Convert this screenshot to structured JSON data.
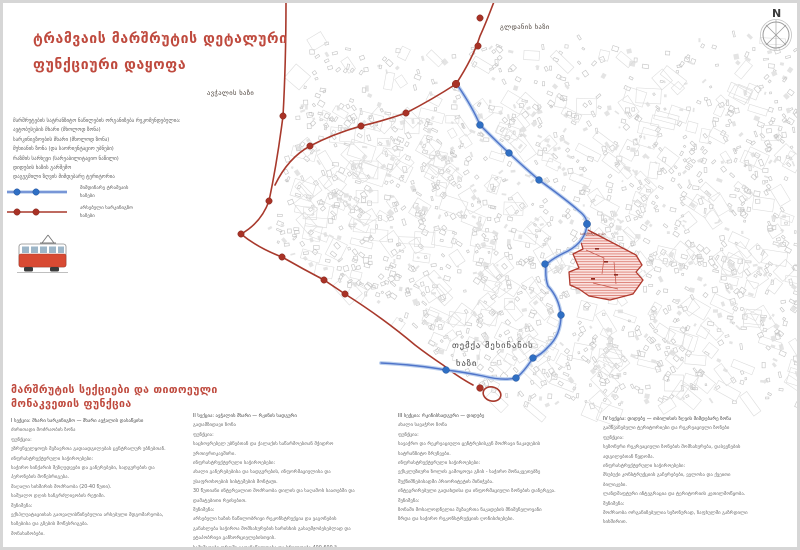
{
  "title": {
    "line1": "ტრამვაის მარშრუტის დეტალური",
    "line2": "ფუნქციური დაყოფა"
  },
  "colors": {
    "accent_red": "#bf4a3e",
    "route_red": "#a8392c",
    "route_blue_core": "#4f74c9",
    "route_blue_halo": "#bcd0ee",
    "station_blue": "#2f6fc4",
    "station_red": "#a93226",
    "zone_fill": "#fbe3e0",
    "zone_hatch": "#dd8077",
    "zone_border": "#b03a2e",
    "fabric_gray": "#c4c4c4"
  },
  "legend": {
    "notes": [
      "მარშრუტების სატრანზიტო ნაწილების ორგანიზება რეკომენდებულია:",
      "ავტობუსების მხარი (მხოლოდ ზონა)",
      "სარკინიგზოების მხარი (მხოლოდ ზონა)",
      "მუხიანის ზონა (და საორიენტაციო უბნები)",
      "რაზმის სარხევი (სარეაბილიტაციო ნაწილი)",
      "დიდუბის ხაზის გარშემო",
      "დაგეგმილი ზღვის მიმდებარე ტერიტორია"
    ],
    "items": [
      {
        "label_line1": "მიმდინარე ტრამვაის",
        "label_line2": "ხაზები"
      },
      {
        "label_line1": "არსებული სარკინიგზო",
        "label_line2": "ხაზები"
      }
    ]
  },
  "map": {
    "north_label": "N",
    "labels": {
      "gldani": "გლდანის ხაზი",
      "avchala": "ავჭალის ხაზი",
      "temka_line1": "თემქა მეხინანის",
      "temka_line2": "ხაზი",
      "depot": "სარემონტო დეპო"
    }
  },
  "sections": {
    "heading_line1": "მარშრუტის სექციები და თითოეული",
    "heading_line2": "მონაკვეთის ფუნქცია",
    "columns": [
      {
        "lines": [
          "I სექცია: მხარი სარკინიგზო — მხარი ავჭალის დასაწყისი",
          "ძირითადი მოძრაობის ზონა",
          "ფუნქცია:",
          "უზრუნველყოფს მგზავრთა გადაადგილებას ცენტრალურ უბნებთან.",
          "ინფრასტრუქტურული საჭიროებები:",
          "საჭირო სიჩქარის შეზღუდვები და გაჩერებები, სადგურების და",
          "პერონების მოწესრიგება.",
          "მაღალი სიხშირის მოძრაობა (20-40 წუთი).",
          "საშუალო დღის ხანგრძლივობის რეჟიმი.",
          "შენიშვნა:",
          "ექსპლუატაციისას გათვალისწინებულია არსებული მდგომარეობა,",
          "ხაზებისა და გზების მოწესრიგება.",
          "მონახაზობები."
        ]
      },
      {
        "lines": [
          "II სექცია: ავჭალის მხარი — რკინის სადგური",
          "გადამზიდავი ზონა",
          "ფუნქცია:",
          "საცხოვრებელ უბნებთან და ქალაქის საწარმოებთან მჭიდრო",
          "ურთიერთკავშირი.",
          "ინფრასტრუქტურული საჭიროებები:",
          "ახალი გაჩერებებისა და სადგურების, ინფორმაციულისა და",
          "უსაფრთხოების სისტემების მონტაჟი.",
          "30 წუთიანი ინტერვალით მოძრაობა დილის და საღამოს საათებში და",
          "დამატებითი რეისებით.",
          "შენიშვნა:",
          "არსებული ხაზის ნაწილობრივი რეკონსტრუქცია და ვაგონების",
          "განახლება საჭიროა მომსახურების ხარისხის გასაუმჯობესებლად და",
          "ეტაპობრივი განხორციელებისთვის.",
          "სამუშაოები დროში გადანაწილდება და სრულდება 400-600 მ."
        ]
      },
      {
        "lines": [
          "III სექცია: რკინისსადგური — დიდუბე",
          "ახალი სავაჭრო ზონა",
          "ფუნქცია:",
          "სავაჭრო და რეკრეაციული ცენტრებისკენ მოძრავი ნაკადების",
          "სატრანზიტო ზრუნვები.",
          "ინფრასტრუქტურული საჭიროებები:",
          "ექსკლუზიური ზოლის გამოყოფა გზის - საჭირო მონაკვეთებზე",
          "შუქნიშნებისადმი პრიორიტეტის მინიჭება.",
          "ინტეგრირებული გადახდისა და ინფორმაციული ზონების დანერგვა.",
          "შენიშვნა:",
          "ზონაში მოსალოდნელია მგზავრთა ნაკადების მნიშვნელოვანი",
          "ზრდა და საჭირო რეკონსტრუქციის ღონისძიებები."
        ]
      },
      {
        "lines": [
          "IV სექცია: დიდუბე — თბილისის ზღვის მიმდებარე ზონა",
          "გამწვანებული ტერიტორიები და რეკრეაციული ზონები",
          "ფუნქცია:",
          "სეზონური რეკრეაციული ზონების მომსახურება, დასვენების",
          "ადგილებთან წვდომა.",
          "ინფრასტრუქტურული საჭიროებები:",
          "მსუბუქი კონსტრუქციის გაჩერებები, ველოსა და ქვეითი",
          "ბილიკები.",
          "ლანდშაფტური ინტეგრაცია და ტერიტორიის კეთილმოწყობა.",
          "შენიშვნა:",
          "მოძრაობა ორგანიზებულია სეზონურად, ზაფხულში გაზრდილი",
          "სიხშირით."
        ]
      }
    ]
  }
}
